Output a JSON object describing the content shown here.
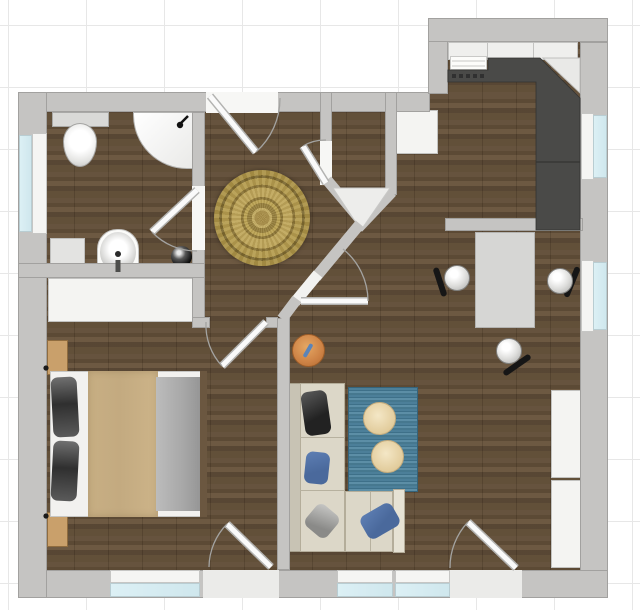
{
  "colors": {
    "grid": "#e7e7e7",
    "wall": "#c5c4c2",
    "wallEdge": "#a2a19f",
    "floor": "#5d4a33",
    "glass": "#cfe7ed",
    "frame": "#f5f5f3",
    "white": "#f4f4f2",
    "counter": "#4a4a48",
    "cabinet": "#efefed",
    "rugGold": "#b09748",
    "rugBlue": "#4a7d97",
    "rugDot": "#eddcba",
    "sofa": "#dcd7c8",
    "sofaEdge": "#b4ad9a",
    "pillowBlue": "#4a699c",
    "pillowDark": "#3a3a3a",
    "duvet": "#c3aa80",
    "blanket": "#a8a8a8",
    "stool": "#cd8245",
    "table": "#d6d6d4",
    "nightstand": "#c9a06b",
    "doorLeaf": "#fafafa",
    "doorArc": "#a3a3a1"
  },
  "plan": {
    "type": "apartment-floor-plan-top-view",
    "rooms": [
      {
        "id": "bathroom",
        "fixtures": [
          "toilet",
          "corner-shower",
          "washbasin",
          "storage-shelf",
          "waste-bin"
        ],
        "windows": [
          "left-wall-window"
        ],
        "doors": [
          "bathroom-door"
        ]
      },
      {
        "id": "hall",
        "fixtures": [
          "round-oriental-rug"
        ],
        "doors": [
          "entrance-door",
          "hall-to-living-door",
          "diagonal-wall-door",
          "bedroom-door"
        ]
      },
      {
        "id": "kitchen",
        "fixtures": [
          "upper-cabinet-row",
          "l-shaped-dark-counter",
          "kitchen-sink",
          "dishwasher",
          "corner-panel"
        ],
        "windows": [
          "right-wall-window-upper"
        ]
      },
      {
        "id": "dining-area",
        "fixtures": [
          "dining-table",
          "dining-chair-left",
          "dining-chair-right",
          "dining-chair-bottom",
          "half-wall"
        ],
        "windows": [
          "right-wall-window-lower"
        ]
      },
      {
        "id": "living-room",
        "fixtures": [
          "corner-sofa",
          "striped-blue-rug",
          "round-side-table-1",
          "round-side-table-2",
          "orange-stool",
          "wall-cabinet-upper",
          "wall-cabinet-lower",
          "white-wardrobe",
          "corner-closet"
        ],
        "windows": [
          "bottom-window-1",
          "bottom-window-2"
        ],
        "doors": [
          "living-balcony-door"
        ]
      },
      {
        "id": "bedroom",
        "fixtures": [
          "double-bed",
          "dark-pillow-top",
          "dark-pillow-bottom",
          "beige-duvet",
          "gray-blanket",
          "nightstand-top",
          "nightstand-bottom",
          "wardrobe-strip"
        ],
        "windows": [
          "bottom-window-bedroom"
        ],
        "doors": [
          "bedroom-balcony-door"
        ]
      }
    ]
  }
}
